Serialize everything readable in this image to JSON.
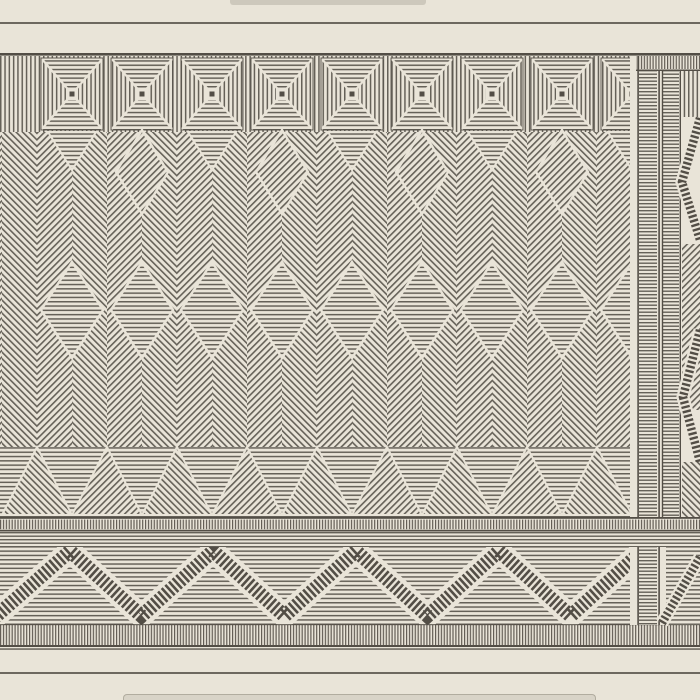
{
  "figure": {
    "kind": "engraving-plate",
    "subject": "Engraved geometric ornamental frieze in woven-mat style: hatched diamond-square band, herringbone field with diamond row, triangle row, dashed zigzag border, ladder divider column and radiating right panel",
    "visible_text": "none"
  },
  "bands": {
    "top_band": "diamond-square-band",
    "field": "herringbone-field",
    "diamond_row": "diamond-row",
    "triangle_row": "triangle-row",
    "tick_band": "tick-band",
    "zigzag_band": "zigzag-band",
    "fringe_band": "fringe-band",
    "divider": "divider-column",
    "right_panel": "right-panel"
  },
  "colors": {
    "paper": "#e9e4d8",
    "ink": "#534e46",
    "strip_top": "#cdc8bc",
    "strip_bottom": "#d8d3c7",
    "strip_bottom_border": "#b1ac9f",
    "rule": "#57524a"
  }
}
